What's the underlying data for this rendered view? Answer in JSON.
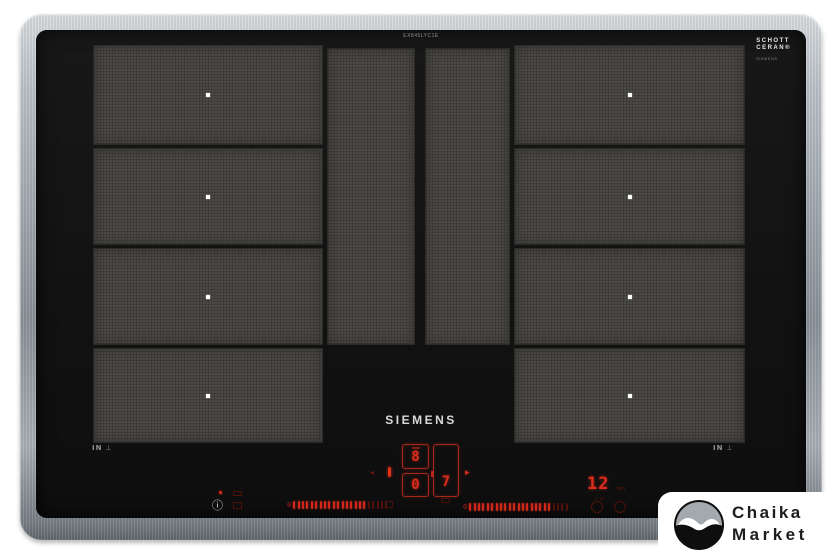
{
  "cooktop": {
    "brand": "SIEMENS",
    "model_label": "EX845LYC1E",
    "glass_label": {
      "line1": "SCHOTT",
      "line2": "CERAN®",
      "sub": "SIEMENS"
    },
    "left_marking": "IN",
    "right_marking": "IN",
    "zones": {
      "left_rows": 4,
      "right_rows": 4,
      "center_columns": 2
    }
  },
  "controls": {
    "zone_display": {
      "top_digit": "8",
      "bottom_digit": "0",
      "side_digit": "7"
    },
    "timer": {
      "value": "12",
      "unit": "min",
      "sub": "1:30"
    },
    "sliders": {
      "left": {
        "zero_label": "0",
        "total": 22,
        "lit": 17
      },
      "right": {
        "zero_label": "0",
        "total": 23,
        "lit": 19
      }
    }
  },
  "icons": {
    "info": "ⓘ",
    "pan_symbol": "⊥",
    "chevron_left": "◂",
    "arrow_right": "▸"
  },
  "watermark": {
    "line1": "Chaika",
    "line2": "Market"
  },
  "colors": {
    "accent_red": "#d2281a",
    "dim_red": "#511009",
    "frame_steel": "#aab0b6",
    "glass_black": "#131313",
    "zone_gray": "#4b4945",
    "card_white": "#ffffff"
  }
}
